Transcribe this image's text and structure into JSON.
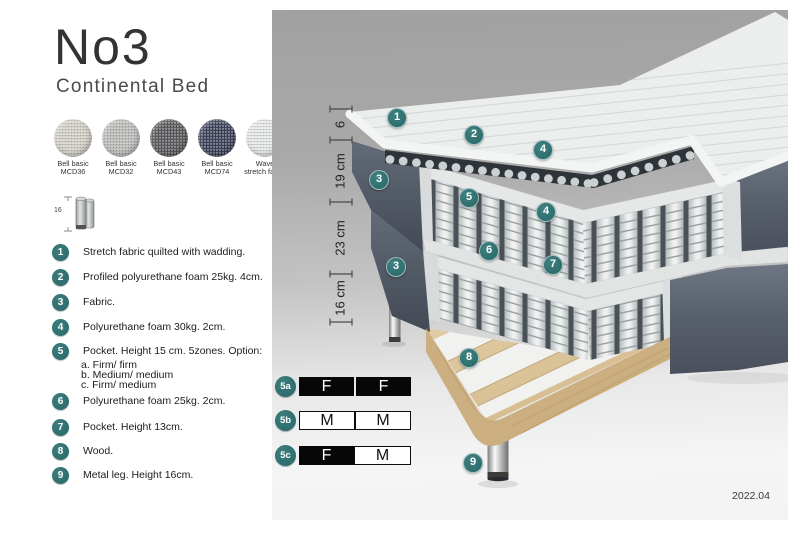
{
  "header": {
    "title": "No3",
    "subtitle": "Continental Bed"
  },
  "fabric_swatches": [
    {
      "line1": "Bell basic",
      "line2": "MCD36",
      "color": "#d4d1c6"
    },
    {
      "line1": "Bell basic",
      "line2": "MCD32",
      "color": "#bcbcba"
    },
    {
      "line1": "Bell basic",
      "line2": "MCD43",
      "color": "#57575a"
    },
    {
      "line1": "Bell basic",
      "line2": "MCD74",
      "color": "#3a3f58"
    },
    {
      "line1": "Wave",
      "line2": "stretch fabric",
      "color": "#e7e9e9"
    }
  ],
  "leg_size_icon": {
    "label": "16"
  },
  "legend": {
    "items": [
      {
        "num": "1",
        "text": "Stretch fabric quilted with wadding."
      },
      {
        "num": "2",
        "text": "Profiled polyurethane foam 25kg. 4cm."
      },
      {
        "num": "3",
        "text": "Fabric."
      },
      {
        "num": "4",
        "text": "Polyurethane foam 30kg. 2cm."
      },
      {
        "num": "5",
        "text": "Pocket. Height 15 cm. 5zones. Option:",
        "options": [
          "a. Firm/ firm",
          "b. Medium/ medium",
          "c. Firm/ medium"
        ]
      },
      {
        "num": "6",
        "text": "Polyurethane foam 25kg. 2cm."
      },
      {
        "num": "7",
        "text": "Pocket. Height 13cm."
      },
      {
        "num": "8",
        "text": "Wood."
      },
      {
        "num": "9",
        "text": "Metal leg. Height 16cm."
      }
    ]
  },
  "diagram": {
    "measurements": [
      {
        "label": "6",
        "from": 99,
        "to": 130
      },
      {
        "label": "19 cm",
        "from": 130,
        "to": 192
      },
      {
        "label": "23 cm",
        "from": 192,
        "to": 264
      },
      {
        "label": "16 cm",
        "from": 264,
        "to": 312
      }
    ],
    "callouts": [
      {
        "label": "1",
        "x": 125,
        "y": 108
      },
      {
        "label": "2",
        "x": 202,
        "y": 125
      },
      {
        "label": "4",
        "x": 271,
        "y": 140
      },
      {
        "label": "3",
        "x": 107,
        "y": 170
      },
      {
        "label": "5",
        "x": 197,
        "y": 188
      },
      {
        "label": "4",
        "x": 274,
        "y": 202
      },
      {
        "label": "6",
        "x": 217,
        "y": 241
      },
      {
        "label": "7",
        "x": 281,
        "y": 255
      },
      {
        "label": "3",
        "x": 124,
        "y": 257
      },
      {
        "label": "8",
        "x": 197,
        "y": 348
      },
      {
        "label": "9",
        "x": 201,
        "y": 453
      }
    ],
    "palette": {
      "callout_teal": "#2e6e6e",
      "fabric_dark": "#59616d",
      "wood": "#d9c096",
      "mattress_white": "#eceeee",
      "spring_background": "#4a5158"
    }
  },
  "firmness_options": {
    "rows": [
      {
        "id": "5a",
        "cells": [
          {
            "letter": "F",
            "style": "dark"
          },
          {
            "letter": "F",
            "style": "dark"
          }
        ]
      },
      {
        "id": "5b",
        "cells": [
          {
            "letter": "M",
            "style": "light"
          },
          {
            "letter": "M",
            "style": "light"
          }
        ]
      },
      {
        "id": "5c",
        "cells": [
          {
            "letter": "F",
            "style": "dark"
          },
          {
            "letter": "M",
            "style": "light"
          }
        ]
      }
    ]
  },
  "version": "2022.04"
}
